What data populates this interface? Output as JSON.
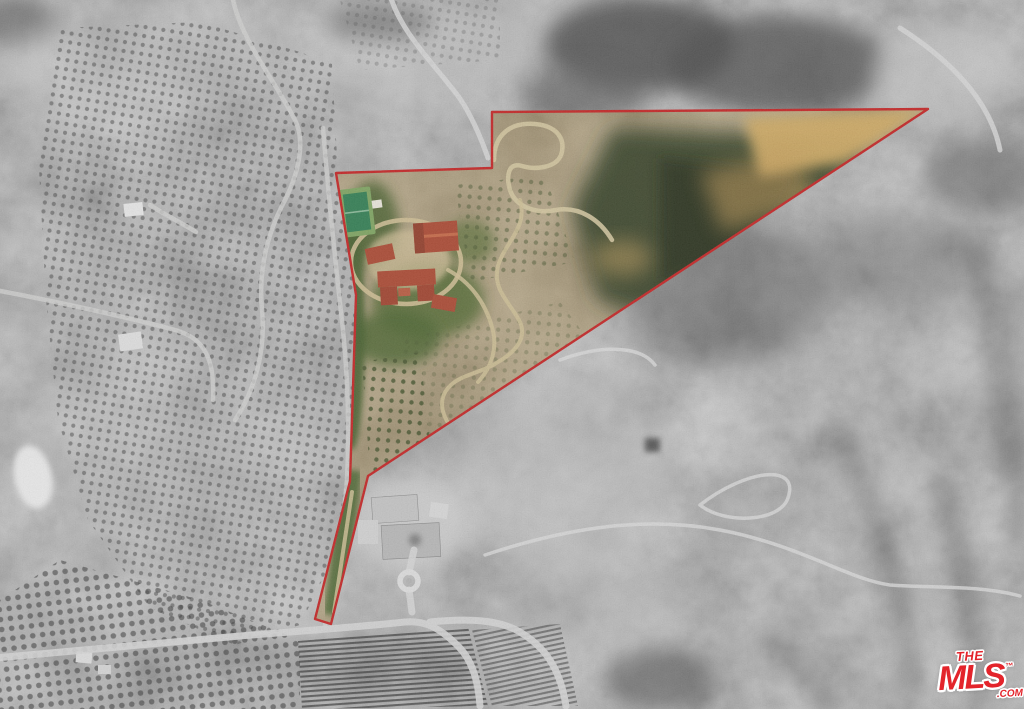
{
  "watermark": {
    "the": "THE",
    "mls": "MLS",
    "tm": "™",
    "com": ".COM",
    "color": "#e3242b",
    "outline_color": "#ffffff"
  },
  "boundary": {
    "points_str": "492,112 928,109 368,476 331,624 315,619 350,481 356,295 336,173 492,168",
    "color": "#c21d1d"
  },
  "palette": {
    "grayscale_base": "#9b9b9b",
    "property_tan": "#a08a5d",
    "property_green": "#4c612f",
    "canyon_dark_olive": "#333d24",
    "golden_ridge": "#cfa85e",
    "terracotta_roof": "#a8432c",
    "tennis_court_green": "#2c7a4e",
    "road_light_gray": "#d4d4d4"
  }
}
